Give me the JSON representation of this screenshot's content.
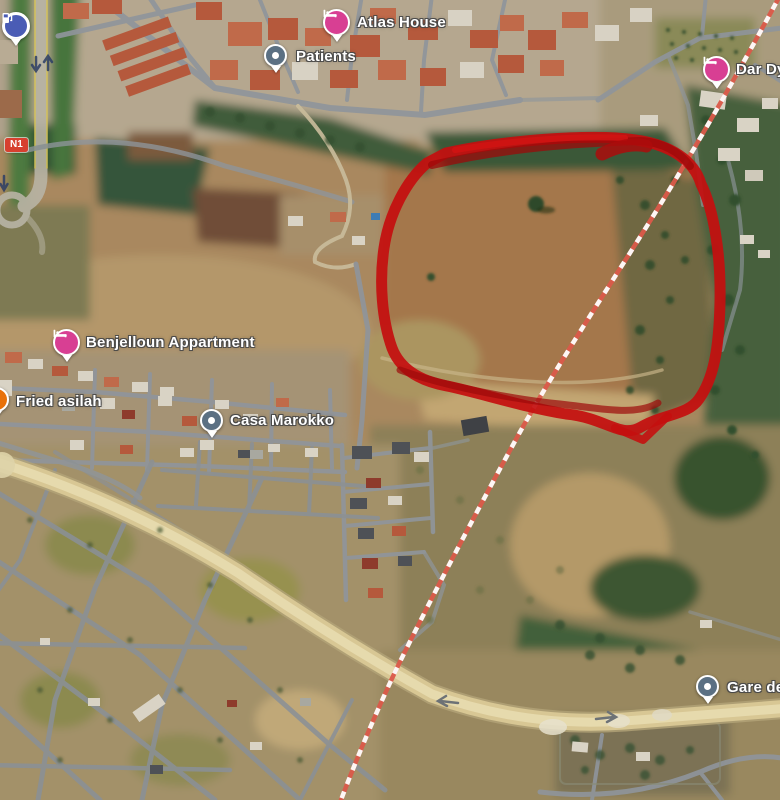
{
  "map": {
    "road_badge": "N1",
    "places": [
      {
        "name": "Atlas House",
        "type": "lodging"
      },
      {
        "name": "Patients",
        "type": "generic"
      },
      {
        "name": "Dar Dy",
        "type": "lodging"
      },
      {
        "name": "Benjelloun Appartment",
        "type": "lodging"
      },
      {
        "name": "Fried asilah",
        "type": "restaurant"
      },
      {
        "name": "Casa Marokko",
        "type": "generic"
      },
      {
        "name": "Gare de",
        "type": "generic"
      }
    ],
    "unlabeled_pins": [
      {
        "type": "gas-station"
      }
    ],
    "colors": {
      "lodging_pin": "#d83f93",
      "generic_pin": "#5b7083",
      "restaurant_pin": "#e8710a",
      "gas_pin": "#4a5cb5",
      "annotation_red": "#c40f0f",
      "boundary_line_red": "#db5a4a",
      "road_badge_bg": "#d7402f"
    }
  }
}
